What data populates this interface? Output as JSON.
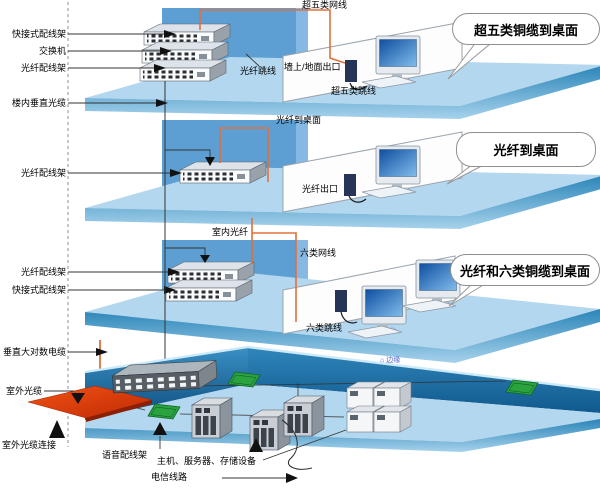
{
  "labels": {
    "f1_quick_patch_panel": "快接式配线架",
    "f1_switch": "交换机",
    "f1_fiber_patch_panel": "光纤配线架",
    "riser_fiber": "楼内垂直光缆",
    "f2_fiber_patch_panel": "光纤配线架",
    "f3_fiber_patch_panel": "光纤配线架",
    "f3_quick_patch_panel": "快接式配线架",
    "riser_copper": "垂直大对数电缆",
    "outdoor_fiber": "室外光缆",
    "outdoor_fiber_connect": "室外光缆连接",
    "f1_cat5e_cable": "超五类网线",
    "f1_fiber_jumper": "光纤跳线",
    "f1_wall_outlet": "墙上/地面出口",
    "f1_cat5e_jumper": "超五类跳线",
    "f2_fiber_to_desk": "光纤到桌面",
    "f2_fiber_outlet": "光纤出口",
    "f3_indoor_fiber": "室内光纤",
    "f3_cat6_cable": "六类网线",
    "f3_cat6_jumper": "六类跳线",
    "b_voice_patch_panel": "语音配线架",
    "b_servers": "主机、服务器、存储设备",
    "b_telecom_line": "电信线路"
  },
  "callouts": {
    "cat5e_to_desktop": "超五类铜缆到桌面",
    "fiber_to_desktop": "光纤到桌面",
    "fiber_cat6_to_desktop": "光纤和六类铜缆到桌面"
  },
  "watermark": {
    "icon": "⌂",
    "text": "边缘"
  },
  "colors": {
    "floor_surface": "#b3d7ee",
    "floor_edge_dark": "#2a84b8",
    "wall_blue": "#5d9fd2",
    "basement_wall_dark": "#0d4d7e",
    "cable_orange": "#e0703c",
    "outdoor_cable_red": "#e63c10",
    "panel_green": "#2aa23e",
    "screen_blue": "#0e4fa0",
    "watermark_blue": "#5063c9"
  }
}
